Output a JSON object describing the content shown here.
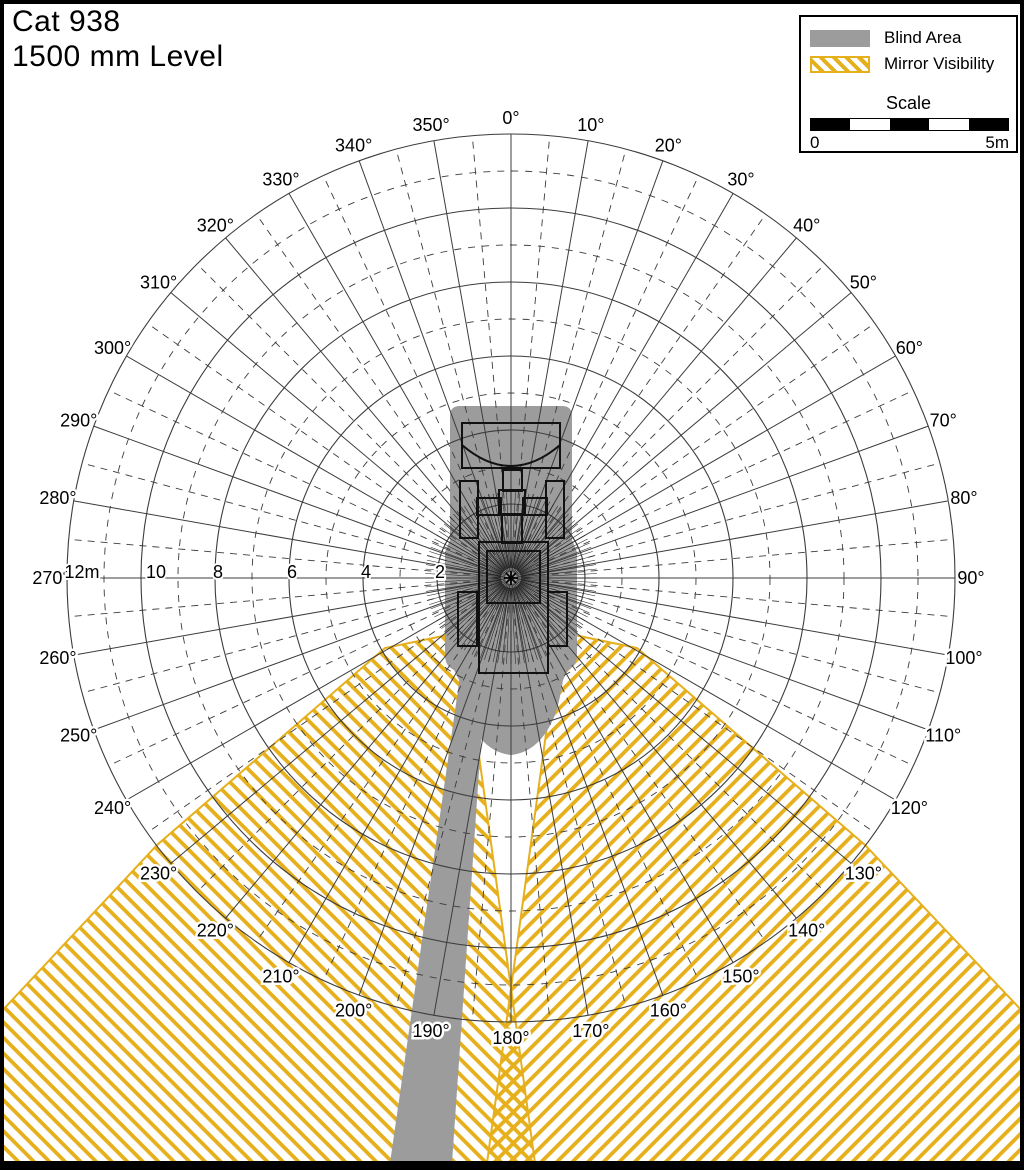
{
  "title": {
    "line1": "Cat 938",
    "line2": "1500 mm Level"
  },
  "legend": {
    "blind_area": "Blind Area",
    "mirror_visibility": "Mirror Visibility",
    "scale_title": "Scale",
    "scale_start": "0",
    "scale_end": "5m",
    "scale_segments": 5
  },
  "colors": {
    "blind_gray": "#9C9C9C",
    "mirror_yellow": "#E6AF1C",
    "grid_line": "#3C3C3C",
    "outline_black": "#111111",
    "frame": "#000000",
    "background": "#FFFFFF"
  },
  "polar": {
    "center_x": 511,
    "center_y": 578,
    "px_per_meter": 37,
    "outer_radius_m": 12,
    "solid_rings_m": [
      2,
      4,
      6,
      8,
      10,
      12
    ],
    "dashed_rings_m": [
      3,
      5,
      7,
      9,
      11
    ],
    "solid_spoke_step_deg": 10,
    "dashed_spoke_offset_deg": 5,
    "sight_ray_step_deg": 3,
    "sight_ray_inner_px": 10,
    "sight_ray_outer_px": 86,
    "angle_label_radius": 460,
    "angle_labels": [
      "0°",
      "10°",
      "20°",
      "30°",
      "40°",
      "50°",
      "60°",
      "70°",
      "80°",
      "90°",
      "100°",
      "110°",
      "120°",
      "130°",
      "140°",
      "150°",
      "160°",
      "170°",
      "180°",
      "190°",
      "200°",
      "210°",
      "220°",
      "230°",
      "240°",
      "250°",
      "260°",
      "270°",
      "280°",
      "290°",
      "300°",
      "310°",
      "320°",
      "330°",
      "340°",
      "350°"
    ],
    "radial_labels": [
      {
        "m": 12,
        "text": "12m"
      },
      {
        "m": 10,
        "text": "10"
      },
      {
        "m": 8,
        "text": "8"
      },
      {
        "m": 6,
        "text": "6"
      },
      {
        "m": 4,
        "text": "4"
      },
      {
        "m": 2,
        "text": "2"
      }
    ]
  },
  "regions": {
    "mirror_left_polygon": [
      [
        462,
        632
      ],
      [
        385,
        648
      ],
      [
        157,
        845
      ],
      [
        0,
        1013
      ],
      [
        0,
        1163
      ],
      [
        535,
        1163
      ]
    ],
    "mirror_right_polygon": [
      [
        560,
        632
      ],
      [
        637,
        648
      ],
      [
        865,
        845
      ],
      [
        1024,
        1013
      ],
      [
        1024,
        1163
      ],
      [
        487,
        1163
      ]
    ],
    "blind_rear_band_polygon": [
      [
        463,
        655
      ],
      [
        487,
        655
      ],
      [
        452,
        1163
      ],
      [
        390,
        1163
      ]
    ],
    "machine_blind_path": "M450,416 Q450,406 460,406 L562,406 Q572,406 572,416 L572,540 L577,552 L577,655 Q577,666 568,670 L563,680 Q560,700 555,715 Q540,752 511,755 Q482,752 467,715 Q462,700 459,680 L454,670 Q445,666 445,655 L445,552 L450,540 Z"
  },
  "machine": {
    "bucket_curve": "M462,445 Q511,487 560,445",
    "parts": [
      {
        "name": "bucket",
        "x": 462,
        "y": 423,
        "w": 98,
        "h": 45
      },
      {
        "name": "linkage",
        "x": 503,
        "y": 470,
        "w": 19,
        "h": 21
      },
      {
        "name": "front-wheel-left",
        "x": 460,
        "y": 481,
        "w": 18,
        "h": 57
      },
      {
        "name": "front-wheel-right",
        "x": 546,
        "y": 481,
        "w": 18,
        "h": 57
      },
      {
        "name": "axle-left",
        "x": 477,
        "y": 498,
        "w": 24,
        "h": 17
      },
      {
        "name": "axle-right",
        "x": 523,
        "y": 498,
        "w": 24,
        "h": 17
      },
      {
        "name": "hitch",
        "x": 499,
        "y": 490,
        "w": 26,
        "h": 25
      },
      {
        "name": "hitch-lower",
        "x": 502,
        "y": 514,
        "w": 20,
        "h": 29
      },
      {
        "name": "rear-body",
        "x": 479,
        "y": 542,
        "w": 69,
        "h": 131
      },
      {
        "name": "cab",
        "x": 487,
        "y": 551,
        "w": 53,
        "h": 52
      },
      {
        "name": "rear-wheel-left",
        "x": 458,
        "y": 592,
        "w": 19,
        "h": 54
      },
      {
        "name": "rear-wheel-right",
        "x": 548,
        "y": 592,
        "w": 19,
        "h": 54
      }
    ]
  }
}
